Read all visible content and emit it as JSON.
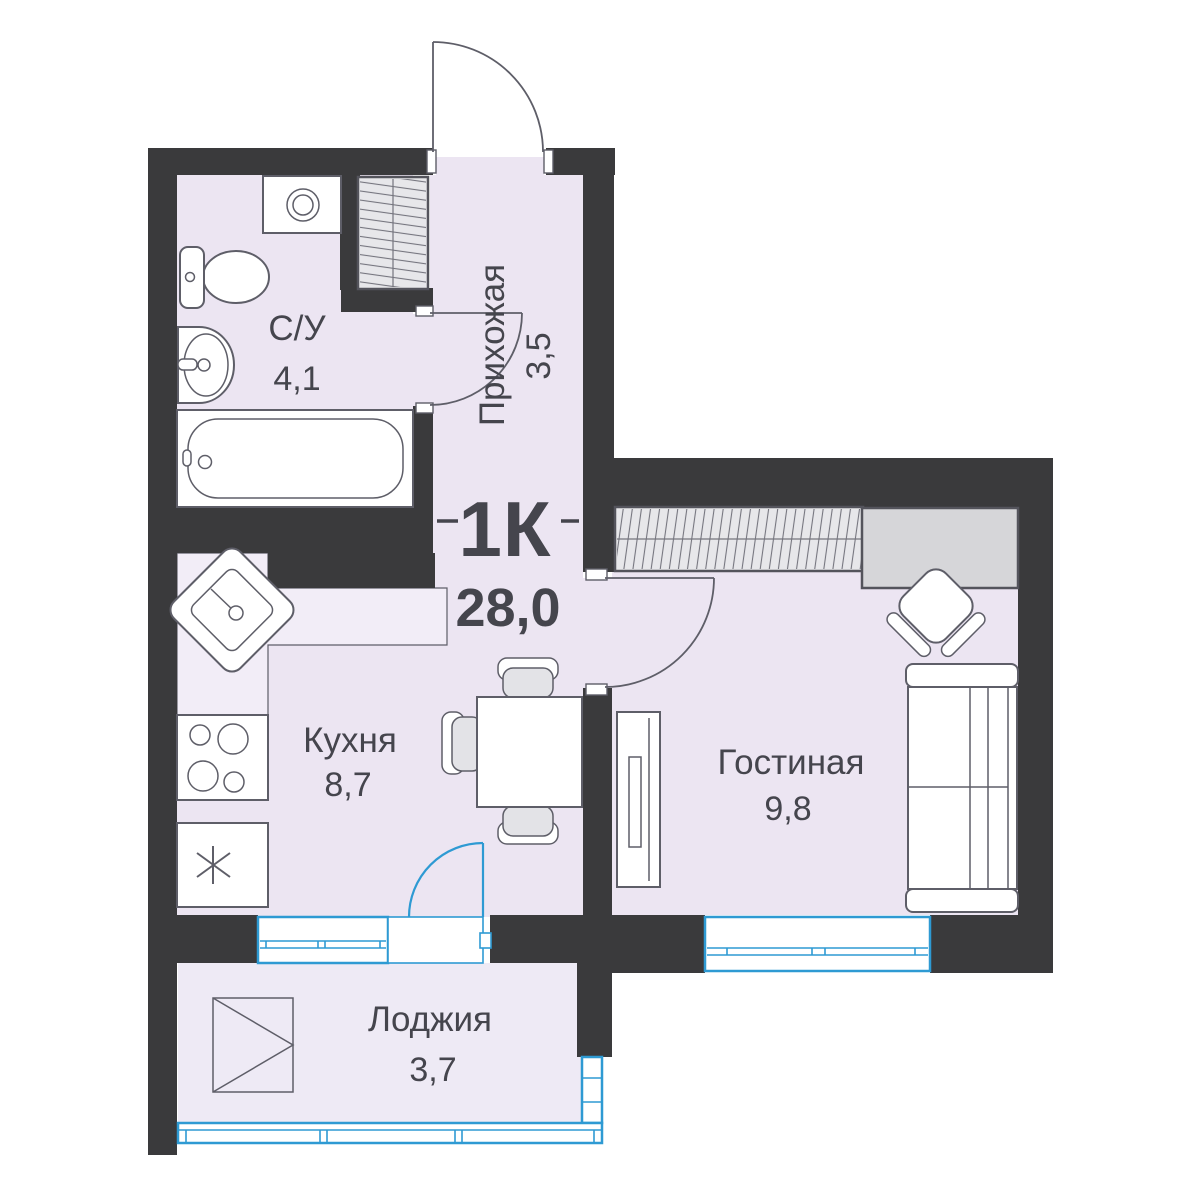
{
  "plan": {
    "type": "1К",
    "total_area": "28,0"
  },
  "rooms": {
    "bathroom": {
      "label": "С/У",
      "area": "4,1"
    },
    "hallway": {
      "label": "Прихожая",
      "area": "3,5"
    },
    "kitchen": {
      "label": "Кухня",
      "area": "8,7"
    },
    "living_room": {
      "label": "Гостиная",
      "area": "9,8"
    },
    "loggia": {
      "label": "Лоджия",
      "area": "3,7"
    }
  },
  "colors": {
    "wall": "#3a3a3c",
    "floor": "#ece5f2",
    "floor-loggia": "#eeeaf5",
    "counter": "#f2edf7",
    "line": "#5e5e68",
    "blue": "#2e9ad3",
    "text": "#45454d",
    "seat": "#e3e3e7",
    "hatch-fill": "#e7e7ea",
    "hatch-border": "#54545c",
    "hatch-line": "#75757e",
    "desk": "#d6d6d9"
  }
}
